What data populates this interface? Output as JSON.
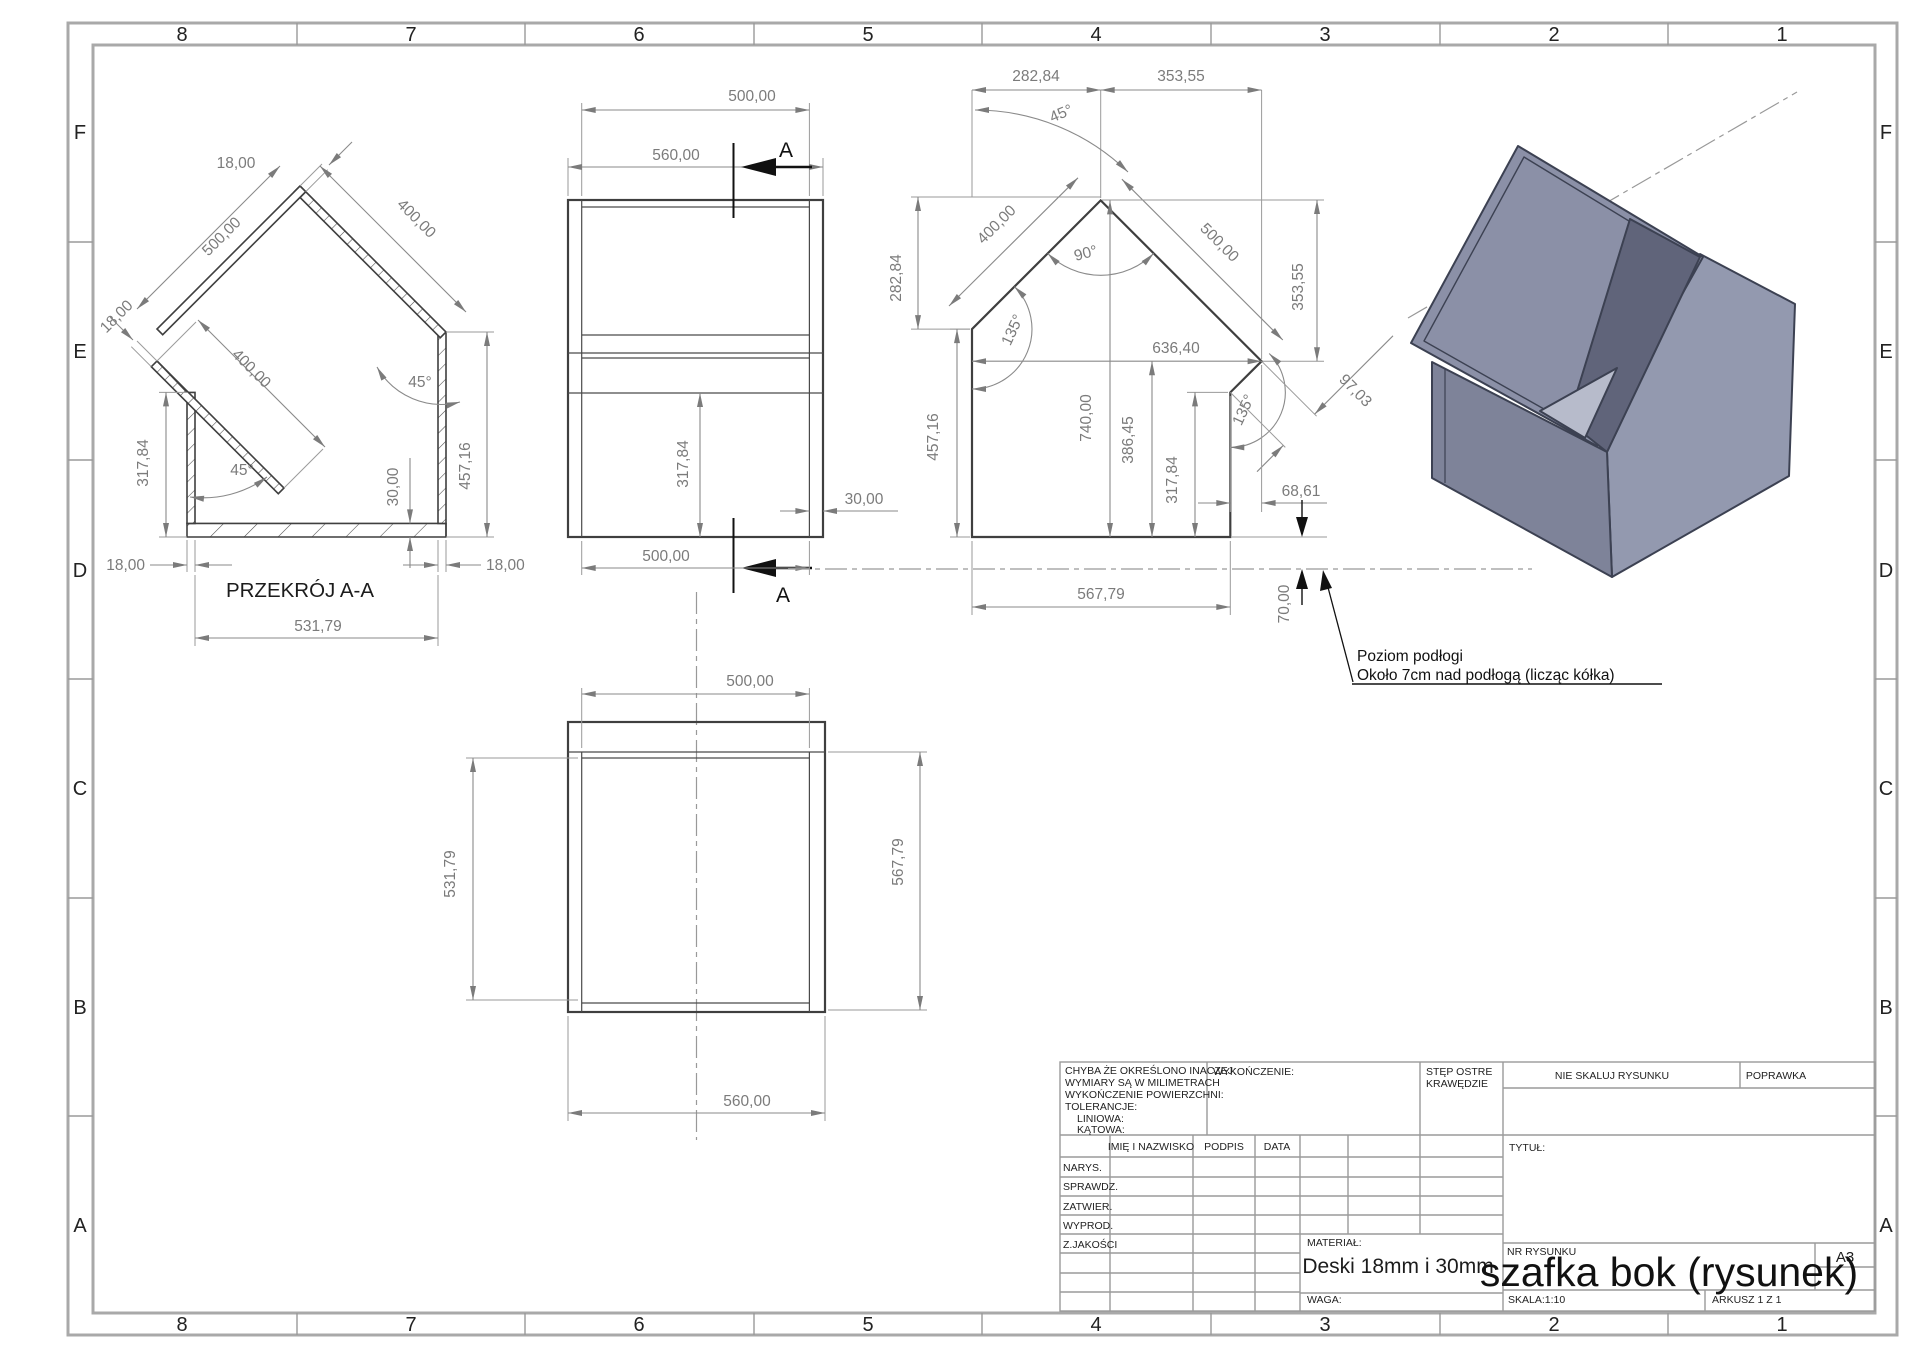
{
  "border": {
    "cols": [
      "8",
      "7",
      "6",
      "5",
      "4",
      "3",
      "2",
      "1"
    ],
    "rows": [
      "F",
      "E",
      "D",
      "C",
      "B",
      "A"
    ]
  },
  "section_view": {
    "title": "PRZEKRÓJ A-A",
    "dims": {
      "thickness_top": "18,00",
      "edge_500": "500,00",
      "roof_400": "400,00",
      "thickness_left": "18,00",
      "inner_400": "400,00",
      "angle_right": "45°",
      "angle_bottom": "45°",
      "left_height": "317,84",
      "bottom_thickness": "30,00",
      "right_height": "457,16",
      "wall_left": "18,00",
      "wall_right": "18,00",
      "inner_width": "531,79"
    }
  },
  "front_view": {
    "cut_label": "A",
    "dims": {
      "top_inner": "500,00",
      "top_outer": "560,00",
      "lower_height": "317,84",
      "wall": "30,00",
      "bottom_inner": "500,00"
    }
  },
  "profile_view": {
    "dims": {
      "top_left": "282,84",
      "top_right": "353,55",
      "angle_top": "45°",
      "left_drop": "282,84",
      "edge_400": "400,00",
      "angle_apex": "90°",
      "edge_500": "500,00",
      "right_drop": "353,55",
      "angle_left": "135°",
      "top_width": "636,40",
      "chamfer": "97,03",
      "angle_chamfer": "135°",
      "left_height": "457,16",
      "total_height": "740,00",
      "right_mid": "386,45",
      "right_height": "317,84",
      "chamfer_x": "68,61",
      "bottom_width": "567,79",
      "floor_gap": "70,00"
    },
    "note_line1": "Poziom podłogi",
    "note_line2": "Około 7cm nad podłogą (licząc kółka)"
  },
  "bottom_view": {
    "dims": {
      "top": "500,00",
      "left": "531,79",
      "right": "567,79",
      "bottom": "560,00"
    }
  },
  "title_block": {
    "tolerance_lines": [
      "CHYBA ŻE OKREŚLONO INACZEJ:",
      "WYMIARY SĄ W MILIMETRACH",
      "WYKOŃCZENIE POWIERZCHNI:",
      "TOLERANCJE:",
      "LINIOWA:",
      "KĄTOWA:"
    ],
    "wykonczenie": "WYKOŃCZENIE:",
    "edges_line1": "STĘP OSTRE",
    "edges_line2": "KRAWĘDZIE",
    "do_not_scale": "NIE SKALUJ RYSUNKU",
    "poprawka": "POPRAWKA",
    "tytul": "TYTUŁ:",
    "headers": [
      "IMIĘ I NAZWISKO",
      "PODPIS",
      "DATA"
    ],
    "rows": [
      "NARYS.",
      "SPRAWDZ.",
      "ZATWIER.",
      "WYPROD.",
      "Z.JAKOŚCI"
    ],
    "material_label": "MATERIAŁ:",
    "material_value": "Deski 18mm i 30mm",
    "nr_label": "NR RYSUNKU",
    "drawing_title": "szafka bok (rysunek)",
    "sheet_size": "A3",
    "waga_label": "WAGA:",
    "skala": "SKALA:1:10",
    "arkusz": "ARKUSZ 1 Z 1"
  }
}
